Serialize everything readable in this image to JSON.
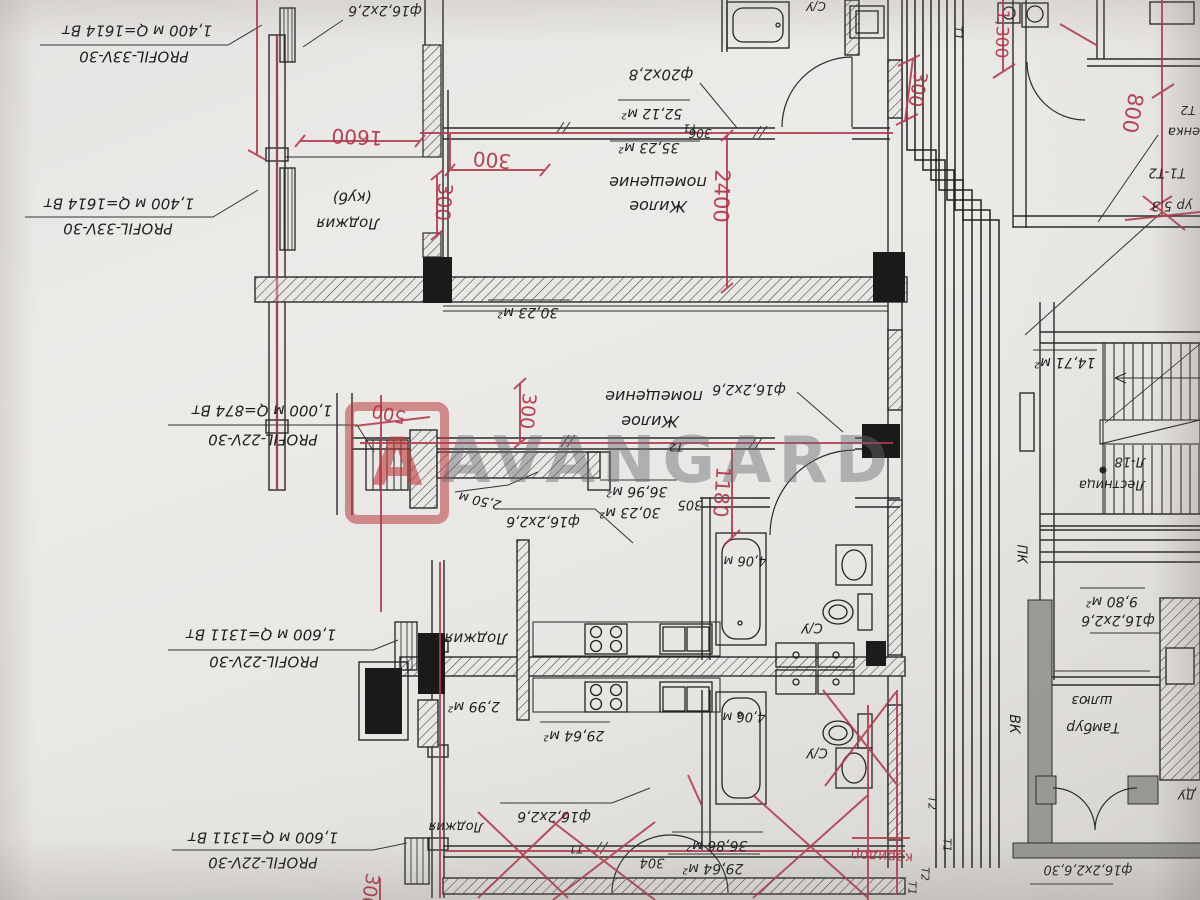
{
  "watermark": {
    "text": "AVANGARD",
    "logo_letter": "A"
  },
  "colors": {
    "paper": "#eae8e5",
    "ink": "#262626",
    "red_pen": "#b03449",
    "watermark_gray": "#69696f",
    "watermark_red": "#ba3a3e"
  },
  "plan_meta": {
    "orientation": "rotated-180",
    "language": "ru",
    "drawing_type": "heating floor plan with red markup"
  },
  "labels": [
    {
      "n": "radiator-spec-label",
      "t": "1,400 м  Q=1614 Вт",
      "x": 137,
      "y": 30,
      "s": 15
    },
    {
      "n": "radiator-spec-label",
      "t": "PROFIL-33V-30",
      "x": 134,
      "y": 56,
      "s": 15
    },
    {
      "n": "radiator-spec-label",
      "t": "1,400 м  Q=1614 Вт",
      "x": 119,
      "y": 203,
      "s": 15
    },
    {
      "n": "radiator-spec-label",
      "t": "PROFIL-33V-30",
      "x": 118,
      "y": 228,
      "s": 15
    },
    {
      "n": "radiator-spec-label",
      "t": "1,000 м  Q=874 Вт",
      "x": 262,
      "y": 410,
      "s": 15
    },
    {
      "n": "radiator-spec-label",
      "t": "PROFIL-22V-30",
      "x": 263,
      "y": 439,
      "s": 15
    },
    {
      "n": "radiator-spec-label",
      "t": "1,600 м  Q=1311 Вт",
      "x": 261,
      "y": 634,
      "s": 15
    },
    {
      "n": "radiator-spec-label",
      "t": "PROFIL-22V-30",
      "x": 264,
      "y": 661,
      "s": 15
    },
    {
      "n": "radiator-spec-label",
      "t": "1,600 м  Q=1311 Вт",
      "x": 263,
      "y": 837,
      "s": 15
    },
    {
      "n": "radiator-spec-label",
      "t": "PROFIL-22V-30",
      "x": 263,
      "y": 862,
      "s": 15
    },
    {
      "n": "pipe-spec-label",
      "t": "ф16,2х2,6",
      "x": 385,
      "y": 10,
      "s": 14
    },
    {
      "n": "room-label",
      "t": "(куб)",
      "x": 352,
      "y": 197,
      "s": 15
    },
    {
      "n": "room-label",
      "t": "Лоджия",
      "x": 348,
      "y": 223,
      "s": 15
    },
    {
      "n": "pipe-spec-label",
      "t": "ф20х2,8",
      "x": 661,
      "y": 74,
      "s": 15
    },
    {
      "n": "area-label",
      "t": "52,12 м²",
      "x": 652,
      "y": 113,
      "s": 14
    },
    {
      "n": "area-label",
      "t": "35,23 м²",
      "x": 649,
      "y": 147,
      "s": 14
    },
    {
      "n": "apartment-number",
      "t": "306",
      "x": 700,
      "y": 133,
      "s": 12
    },
    {
      "n": "room-label",
      "t": "С/У",
      "x": 816,
      "y": 6,
      "s": 12
    },
    {
      "n": "room-label",
      "t": "помещение",
      "x": 658,
      "y": 182,
      "s": 16
    },
    {
      "n": "room-label",
      "t": "Жилое",
      "x": 658,
      "y": 206,
      "s": 16
    },
    {
      "n": "area-label",
      "t": "30,23 м²",
      "x": 528,
      "y": 312,
      "s": 14
    },
    {
      "n": "room-label",
      "t": "помещение",
      "x": 654,
      "y": 396,
      "s": 16
    },
    {
      "n": "room-label",
      "t": "Жилое",
      "x": 650,
      "y": 421,
      "s": 16
    },
    {
      "n": "pipe-spec-label",
      "t": "ф16,2х2,6",
      "x": 749,
      "y": 389,
      "s": 14
    },
    {
      "n": "area-label",
      "t": "36,96 м²",
      "x": 637,
      "y": 491,
      "s": 14
    },
    {
      "n": "area-label",
      "t": "30,23 м²",
      "x": 630,
      "y": 512,
      "s": 14
    },
    {
      "n": "apartment-number",
      "t": "305",
      "x": 690,
      "y": 504,
      "s": 13
    },
    {
      "n": "length-label",
      "t": "2,50 м",
      "x": 480,
      "y": 500,
      "s": 13,
      "rot": 192
    },
    {
      "n": "pipe-spec-label",
      "t": "ф16,2х2,6",
      "x": 543,
      "y": 521,
      "s": 14
    },
    {
      "n": "pipe-tag",
      "t": "Т2",
      "x": 676,
      "y": 447,
      "s": 11
    },
    {
      "n": "pipe-tag",
      "t": "Т1",
      "x": 690,
      "y": 128,
      "s": 11
    },
    {
      "n": "room-label",
      "t": "Лоджия",
      "x": 476,
      "y": 638,
      "s": 15
    },
    {
      "n": "area-label",
      "t": "2,99 м²",
      "x": 474,
      "y": 706,
      "s": 14
    },
    {
      "n": "area-label",
      "t": "29,64 м²",
      "x": 574,
      "y": 735,
      "s": 14
    },
    {
      "n": "length-label",
      "t": "4,06 м",
      "x": 745,
      "y": 560,
      "s": 13
    },
    {
      "n": "room-label",
      "t": "С/У",
      "x": 812,
      "y": 627,
      "s": 13
    },
    {
      "n": "length-label",
      "t": "4,06 м",
      "x": 744,
      "y": 716,
      "s": 13
    },
    {
      "n": "room-label",
      "t": "С/У",
      "x": 817,
      "y": 752,
      "s": 13
    },
    {
      "n": "room-label",
      "t": "Лоджия",
      "x": 456,
      "y": 826,
      "s": 13
    },
    {
      "n": "pipe-spec-label",
      "t": "ф16,2х2,6",
      "x": 554,
      "y": 816,
      "s": 14
    },
    {
      "n": "area-label",
      "t": "36,86 м²",
      "x": 717,
      "y": 845,
      "s": 14
    },
    {
      "n": "area-label",
      "t": "29,64 м²",
      "x": 713,
      "y": 868,
      "s": 14
    },
    {
      "n": "apartment-number",
      "t": "304",
      "x": 652,
      "y": 862,
      "s": 13
    },
    {
      "n": "pipe-tag",
      "t": "Т1",
      "x": 576,
      "y": 849,
      "s": 11
    },
    {
      "n": "pipe-tag",
      "t": "Т1",
      "x": 958,
      "y": 33,
      "s": 11,
      "rot": 90
    },
    {
      "n": "pipe-tag",
      "t": "Т2",
      "x": 1188,
      "y": 110,
      "s": 12
    },
    {
      "n": "note-label",
      "t": "енка",
      "x": 1184,
      "y": 131,
      "s": 13
    },
    {
      "n": "pipe-tag",
      "t": "Т1-Т2",
      "x": 1167,
      "y": 172,
      "s": 13
    },
    {
      "n": "note-label",
      "t": "ур 5.3",
      "x": 1172,
      "y": 205,
      "s": 13
    },
    {
      "n": "area-label",
      "t": "14,71 м²",
      "x": 1065,
      "y": 362,
      "s": 14
    },
    {
      "n": "room-label",
      "t": "Л-18",
      "x": 1130,
      "y": 461,
      "s": 13
    },
    {
      "n": "room-label",
      "t": "Лестница",
      "x": 1112,
      "y": 484,
      "s": 13
    },
    {
      "n": "area-label",
      "t": "9,80 м²",
      "x": 1112,
      "y": 601,
      "s": 14
    },
    {
      "n": "pipe-spec-label",
      "t": "ф16,2х2,6",
      "x": 1118,
      "y": 620,
      "s": 14
    },
    {
      "n": "room-label",
      "t": "шлюз",
      "x": 1092,
      "y": 700,
      "s": 14
    },
    {
      "n": "room-label",
      "t": "Тамбур",
      "x": 1093,
      "y": 727,
      "s": 14
    },
    {
      "n": "room-label",
      "t": "ВК",
      "x": 1014,
      "y": 724,
      "s": 14,
      "rot": 90
    },
    {
      "n": "room-label",
      "t": "ПК",
      "x": 1021,
      "y": 554,
      "s": 13,
      "rot": 90
    },
    {
      "n": "room-label",
      "t": "ДУ",
      "x": 1187,
      "y": 793,
      "s": 13
    },
    {
      "n": "pipe-spec-label",
      "t": "ф16,2х2,6,30",
      "x": 1088,
      "y": 869,
      "s": 13
    },
    {
      "n": "pipe-tag",
      "t": "Т2",
      "x": 932,
      "y": 803,
      "s": 11,
      "rot": 90
    },
    {
      "n": "pipe-tag",
      "t": "Т1",
      "x": 947,
      "y": 845,
      "s": 11,
      "rot": 90
    },
    {
      "n": "pipe-tag",
      "t": "Т2",
      "x": 925,
      "y": 874,
      "s": 11,
      "rot": 90
    },
    {
      "n": "pipe-tag",
      "t": "Т1",
      "x": 912,
      "y": 888,
      "s": 11,
      "rot": 90
    },
    {
      "n": "red-dimension",
      "t": "1600",
      "x": 357,
      "y": 137,
      "s": 20,
      "c": "r",
      "rot": 183
    },
    {
      "n": "red-dimension",
      "t": "300",
      "x": 492,
      "y": 160,
      "s": 20,
      "c": "r",
      "rot": 185
    },
    {
      "n": "red-dimension",
      "t": "300",
      "x": 444,
      "y": 202,
      "s": 20,
      "c": "r",
      "rot": 95
    },
    {
      "n": "red-dimension",
      "t": "2400",
      "x": 721,
      "y": 196,
      "s": 21,
      "c": "r",
      "rot": 92
    },
    {
      "n": "red-dimension",
      "t": "300",
      "x": 917,
      "y": 89,
      "s": 19,
      "c": "r",
      "rot": 100
    },
    {
      "n": "red-dimension",
      "t": "1,300",
      "x": 1001,
      "y": 34,
      "s": 17,
      "c": "r",
      "rot": 92
    },
    {
      "n": "red-dimension",
      "t": "800",
      "x": 1132,
      "y": 113,
      "s": 21,
      "c": "r",
      "rot": 100
    },
    {
      "n": "red-dimension",
      "t": "500",
      "x": 389,
      "y": 413,
      "s": 18,
      "c": "r",
      "rot": 192
    },
    {
      "n": "red-dimension",
      "t": "300",
      "x": 527,
      "y": 411,
      "s": 19,
      "c": "r",
      "rot": 95
    },
    {
      "n": "red-dimension",
      "t": "1180",
      "x": 722,
      "y": 492,
      "s": 20,
      "c": "r",
      "rot": 94
    },
    {
      "n": "red-note",
      "t": "коридор",
      "x": 882,
      "y": 856,
      "s": 14,
      "c": "r",
      "rot": 183
    },
    {
      "n": "red-dimension",
      "t": "300",
      "x": 369,
      "y": 891,
      "s": 19,
      "c": "r",
      "rot": 100
    }
  ]
}
